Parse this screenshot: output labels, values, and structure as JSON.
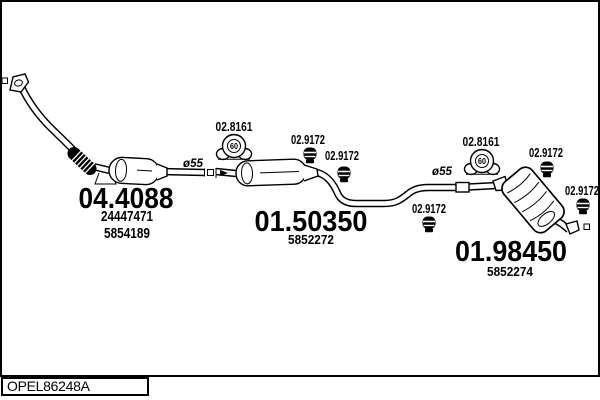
{
  "drawing": {
    "background": "#ffffff",
    "line_color": "#000000"
  },
  "footer": {
    "drawing_code": "OPEL86248A"
  },
  "parts": {
    "front_pipe_catalyst": {
      "mts_number": "04.4088",
      "oe_number_1": "24447471",
      "oe_number_2": "5854189"
    },
    "middle_silencer": {
      "mts_number": "01.50350",
      "oe_number": "5852272"
    },
    "rear_silencer": {
      "mts_number": "01.98450",
      "oe_number": "5852274"
    }
  },
  "annotations": {
    "rubber_mounts": [
      {
        "mts_number": "02.8161",
        "diameter": "60"
      },
      {
        "mts_number": "02.8161",
        "diameter": "60"
      }
    ],
    "clamps": [
      {
        "mts_number": "02.9172"
      },
      {
        "mts_number": "02.9172"
      },
      {
        "mts_number": "02.9172"
      },
      {
        "mts_number": "02.9172"
      },
      {
        "mts_number": "02.9172"
      }
    ],
    "pipe_diameters": [
      {
        "label": "ø55"
      },
      {
        "label": "ø55"
      }
    ]
  }
}
